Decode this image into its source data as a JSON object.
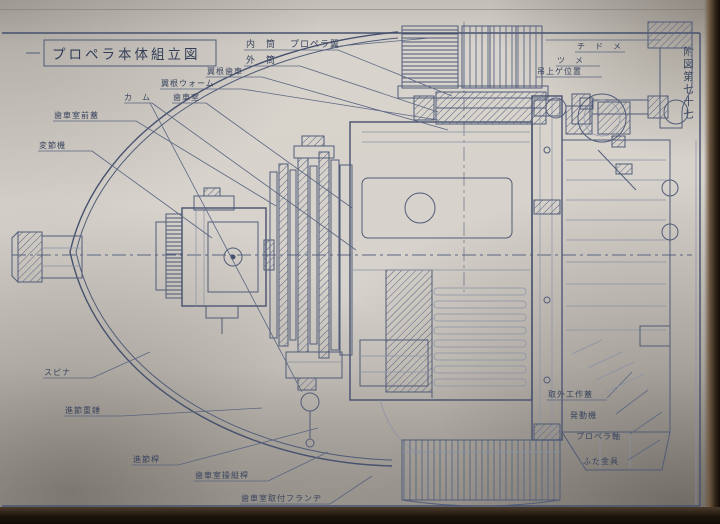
{
  "document": {
    "title": "プロペラ本体組立図",
    "figure_number": "附図第七十七"
  },
  "labels": {
    "inner_cylinder": "内　筒",
    "propeller_blade": "プロペラ翼",
    "outer_cylinder": "外　筒",
    "blade_root_gear": "翼根歯車",
    "blade_root_worm": "翼根ウォーム",
    "cam": "カ　ム",
    "gear_chamber": "歯車室",
    "gear_chamber_front_cover": "歯車室前蓋",
    "pitch_change_mechanism": "変節機",
    "spinner": "スピナ",
    "pitch_change_weight": "進節重錘",
    "pitch_change_rod": "進節桿",
    "gear_chamber_control_rod": "歯車室操縦桿",
    "gear_chamber_mount_flange": "歯車室取付フランヂ",
    "stopper": "チ　ド　メ",
    "claw": "ツ　メ",
    "lift_position": "吊上ゲ位置",
    "removal_work_cover": "取外工作蓋",
    "engine": "発動機",
    "propeller_shaft": "プロペラ軸",
    "cover_fitting": "ふた金具"
  },
  "colors": {
    "paper": "#d6d2cb",
    "ink": "#515c78",
    "ink_dark": "#39445e",
    "photo_background": "#1a130d"
  }
}
